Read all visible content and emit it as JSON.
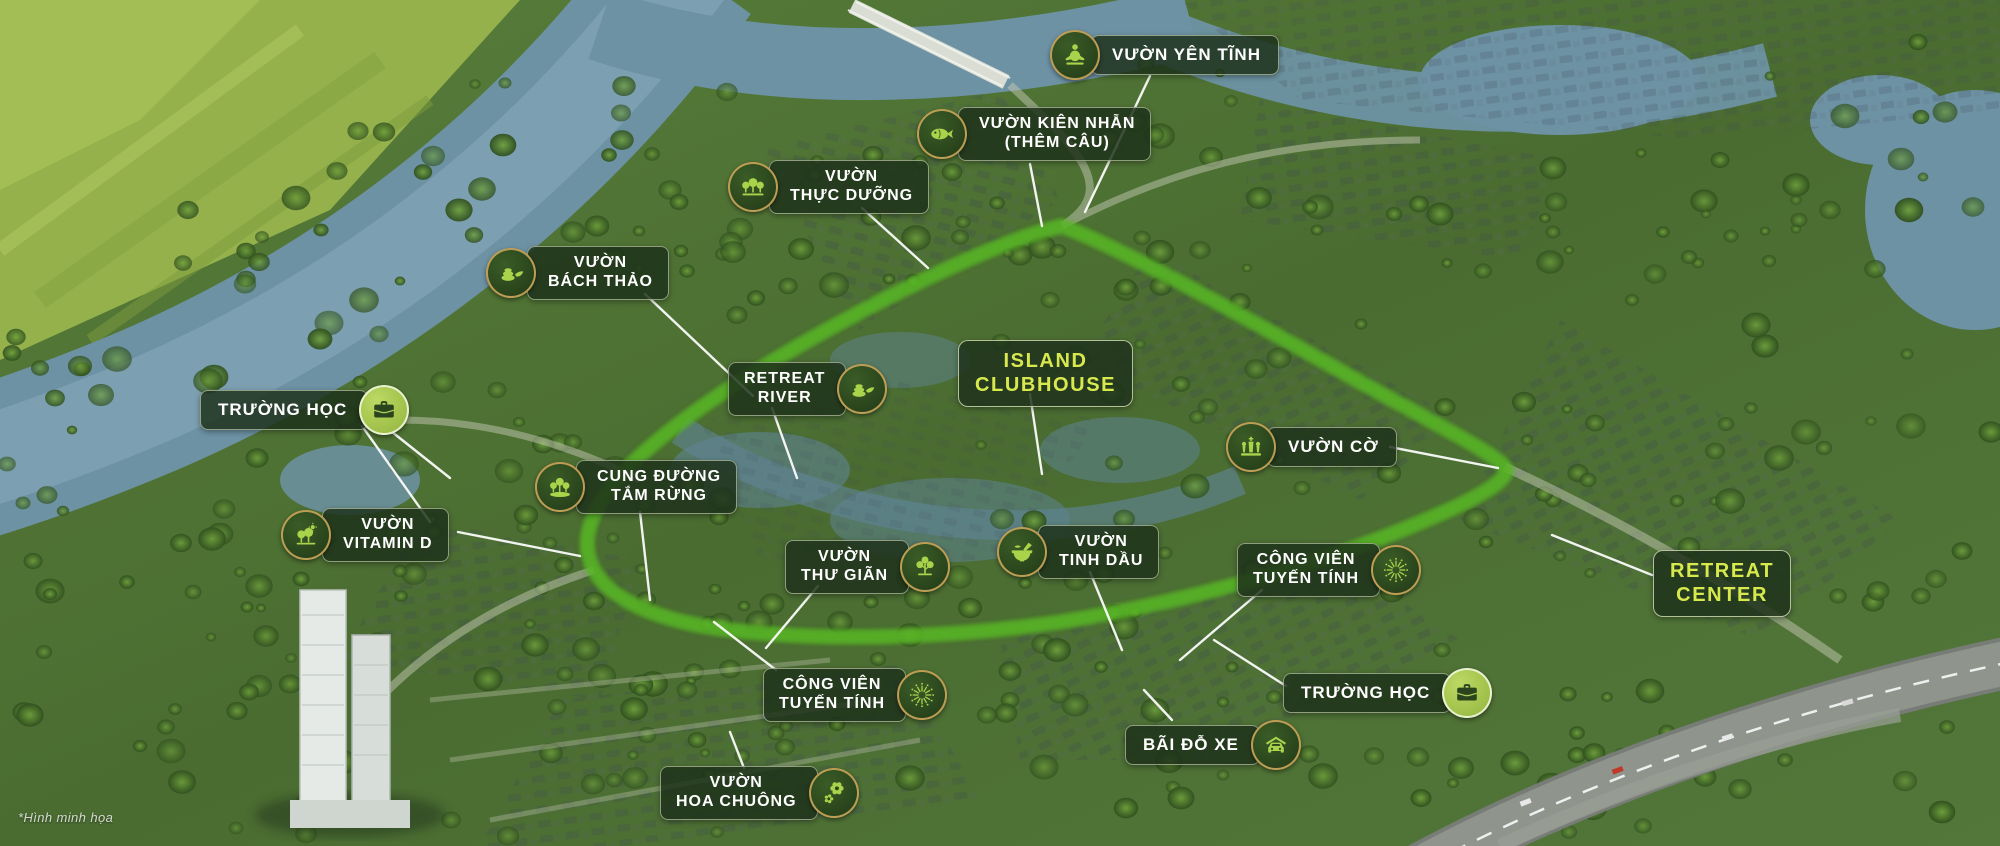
{
  "watermark": "*Hình minh họa",
  "colors": {
    "loop_green": "#7dd32f",
    "loop_glow": "#59b526",
    "loop_highlight": "#b9ef66",
    "label_bg": "rgba(30,49,26,0.84)",
    "label_text": "#ffffff",
    "highlight_text": "#d8e94e",
    "icon_glyph": "#a9d34b",
    "icon_glyph_dark": "#2a451d",
    "icon_ring_gold": "#cda65a",
    "water": "#6d92a4",
    "field": "#94b14c",
    "leader_line": "#ffffff"
  },
  "labels": [
    {
      "id": "vuon-yen-tinh",
      "lines": [
        "VƯỜN YÊN TĨNH"
      ],
      "icon": "meditation-icon",
      "icon_side": "left",
      "badge_style": "dark",
      "style": "default",
      "x": 1050,
      "y": 30,
      "leader": [
        [
          1150,
          76,
          1085,
          212
        ]
      ]
    },
    {
      "id": "vuon-kien-nhan",
      "lines": [
        "VƯỜN KIÊN NHẪN",
        "(THÊM CÂU)"
      ],
      "icon": "fish-icon",
      "icon_side": "left",
      "badge_style": "dark",
      "style": "default",
      "x": 917,
      "y": 107,
      "leader": [
        [
          1030,
          164,
          1042,
          226
        ]
      ]
    },
    {
      "id": "vuon-thuc-duong",
      "lines": [
        "VƯỜN",
        "THỰC DƯỠNG"
      ],
      "icon": "trees-icon",
      "icon_side": "left",
      "badge_style": "dark",
      "style": "default",
      "x": 728,
      "y": 160,
      "leader": [
        [
          862,
          208,
          928,
          268
        ]
      ]
    },
    {
      "id": "vuon-bach-thao",
      "lines": [
        "VƯỜN",
        "BÁCH THẢO"
      ],
      "icon": "zen-stones-icon",
      "icon_side": "left",
      "badge_style": "dark",
      "style": "default",
      "x": 486,
      "y": 246,
      "leader": [
        [
          645,
          294,
          753,
          396
        ]
      ]
    },
    {
      "id": "truong-hoc-tay",
      "lines": [
        "TRƯỜNG HỌC"
      ],
      "icon": "briefcase-icon",
      "icon_side": "right",
      "badge_style": "light",
      "style": "default",
      "x": 200,
      "y": 385,
      "leader": [
        [
          382,
          424,
          450,
          478
        ],
        [
          362,
          426,
          430,
          522
        ]
      ]
    },
    {
      "id": "vuon-vitamin-d",
      "lines": [
        "VƯỜN",
        "VITAMIN D"
      ],
      "icon": "trees-sun-icon",
      "icon_side": "left",
      "badge_style": "dark",
      "style": "default",
      "x": 281,
      "y": 508,
      "leader": [
        [
          458,
          532,
          580,
          556
        ]
      ]
    },
    {
      "id": "cung-duong-tam-rung",
      "lines": [
        "CUNG ĐƯỜNG",
        "TẮM RỪNG"
      ],
      "icon": "forest-icon",
      "icon_side": "left",
      "badge_style": "dark",
      "style": "default",
      "x": 535,
      "y": 460,
      "leader": [
        [
          640,
          512,
          650,
          600
        ]
      ]
    },
    {
      "id": "retreat-river",
      "lines": [
        "RETREAT",
        "RIVER"
      ],
      "icon": "zen-stones-icon",
      "icon_side": "right",
      "badge_style": "dark",
      "style": "default",
      "x": 728,
      "y": 362,
      "leader": [
        [
          772,
          408,
          797,
          478
        ]
      ]
    },
    {
      "id": "island-clubhouse",
      "lines": [
        "ISLAND",
        "CLUBHOUSE"
      ],
      "icon": null,
      "icon_side": "none",
      "badge_style": "none",
      "style": "highlight",
      "x": 958,
      "y": 340,
      "leader": [
        [
          1030,
          394,
          1042,
          474
        ]
      ]
    },
    {
      "id": "vuon-co",
      "lines": [
        "VƯỜN CỜ"
      ],
      "icon": "chess-icon",
      "icon_side": "left",
      "badge_style": "dark",
      "style": "default",
      "x": 1226,
      "y": 422,
      "leader": [
        [
          1390,
          447,
          1498,
          468
        ]
      ]
    },
    {
      "id": "vuon-thu-gian",
      "lines": [
        "VƯỜN",
        "THƯ GIÃN"
      ],
      "icon": "tree-icon",
      "icon_side": "right",
      "badge_style": "dark",
      "style": "default",
      "x": 785,
      "y": 540,
      "leader": [
        [
          818,
          586,
          766,
          648
        ]
      ]
    },
    {
      "id": "vuon-tinh-dau",
      "lines": [
        "VƯỜN",
        "TINH DẦU"
      ],
      "icon": "mortar-icon",
      "icon_side": "left",
      "badge_style": "dark",
      "style": "default",
      "x": 997,
      "y": 525,
      "leader": [
        [
          1090,
          572,
          1122,
          650
        ]
      ]
    },
    {
      "id": "cong-vien-tuyen-tinh-dong",
      "lines": [
        "CÔNG VIÊN",
        "TUYẾN TÍNH"
      ],
      "icon": "starburst-icon",
      "icon_side": "right",
      "badge_style": "dark",
      "style": "default",
      "x": 1237,
      "y": 543,
      "leader": [
        [
          1262,
          590,
          1180,
          660
        ]
      ]
    },
    {
      "id": "retreat-center",
      "lines": [
        "RETREAT",
        "CENTER"
      ],
      "icon": null,
      "icon_side": "none",
      "badge_style": "none",
      "style": "highlight",
      "x": 1653,
      "y": 550,
      "leader": [
        [
          1652,
          575,
          1552,
          535
        ]
      ]
    },
    {
      "id": "truong-hoc-nam",
      "lines": [
        "TRƯỜNG HỌC"
      ],
      "icon": "briefcase-icon",
      "icon_side": "right",
      "badge_style": "light",
      "style": "default",
      "x": 1283,
      "y": 668,
      "leader": [
        [
          1286,
          686,
          1214,
          640
        ]
      ]
    },
    {
      "id": "bai-do-xe",
      "lines": [
        "BÃI ĐỖ XE"
      ],
      "icon": "car-icon",
      "icon_side": "right",
      "badge_style": "dark",
      "style": "default",
      "x": 1125,
      "y": 720,
      "leader": [
        [
          1172,
          720,
          1144,
          690
        ]
      ]
    },
    {
      "id": "cong-vien-tuyen-tinh-nam",
      "lines": [
        "CÔNG VIÊN",
        "TUYẾN TÍNH"
      ],
      "icon": "starburst-icon",
      "icon_side": "right",
      "badge_style": "dark",
      "style": "default",
      "x": 763,
      "y": 668,
      "leader": [
        [
          776,
          670,
          714,
          622
        ]
      ]
    },
    {
      "id": "vuon-hoa-chuong",
      "lines": [
        "VƯỜN",
        "HOA CHUÔNG"
      ],
      "icon": "flower-icon",
      "icon_side": "right",
      "badge_style": "dark",
      "style": "default",
      "x": 660,
      "y": 766,
      "leader": [
        [
          744,
          768,
          730,
          732
        ]
      ]
    }
  ]
}
